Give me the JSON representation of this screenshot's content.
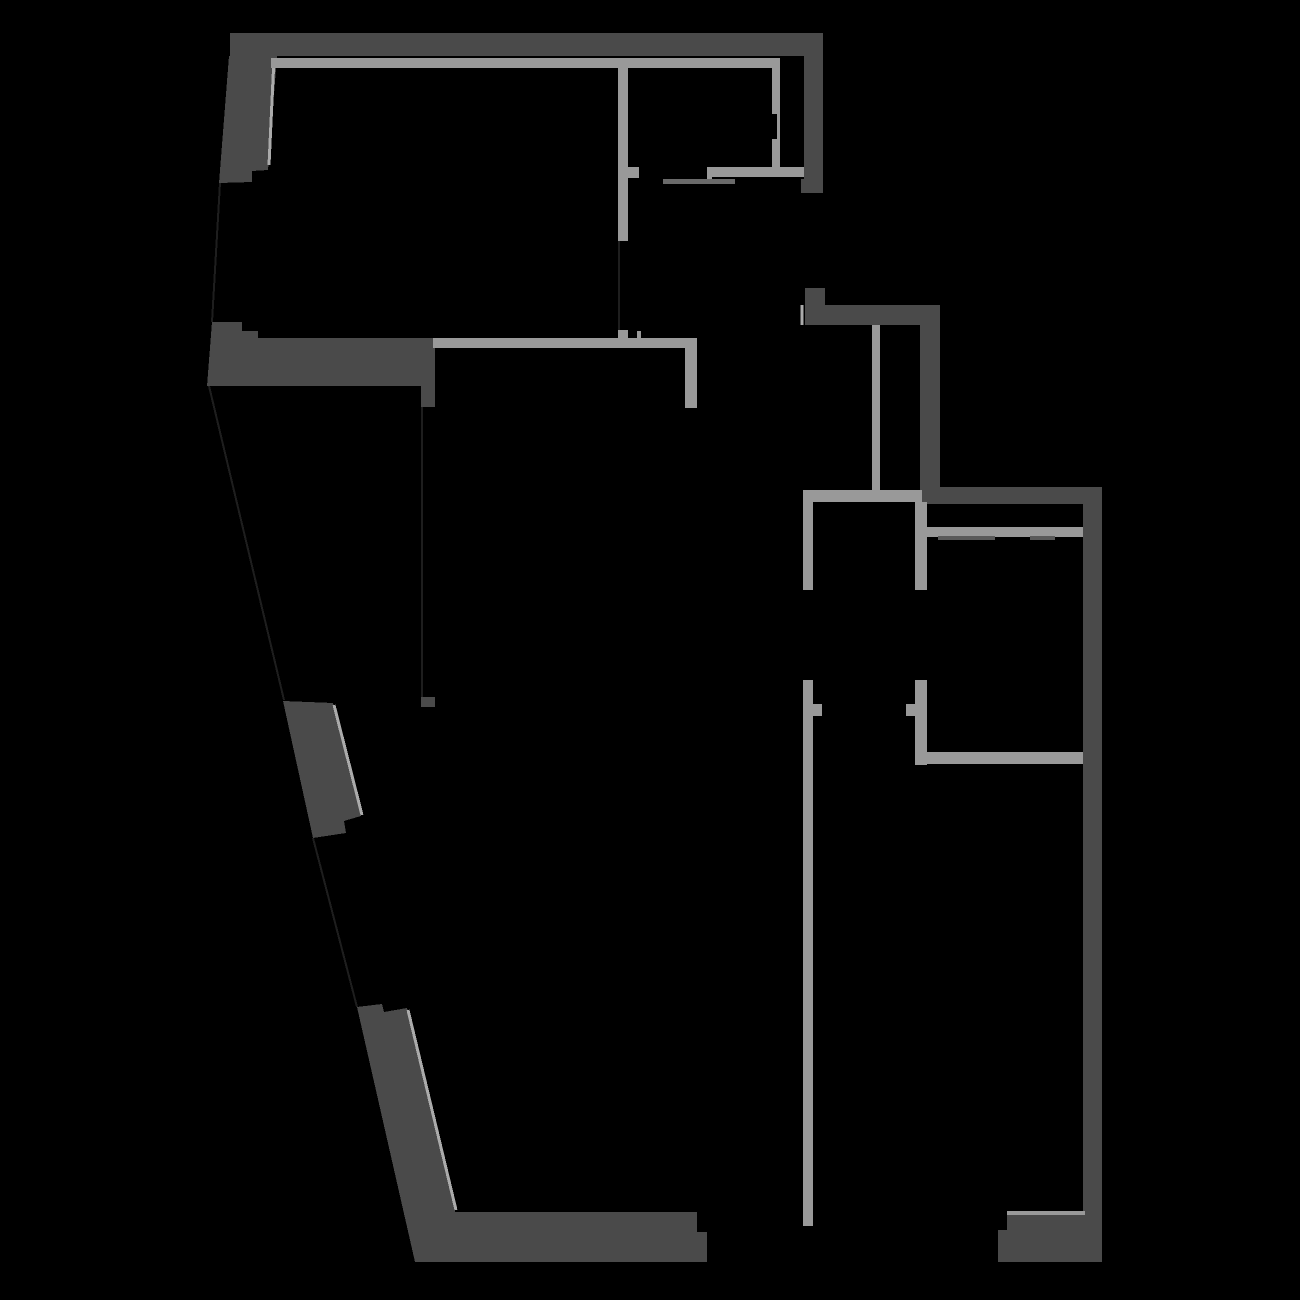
{
  "scene": {
    "type": "architectural-floor-plan",
    "background": "#000000",
    "canvas_width": 1300,
    "canvas_height": 1300
  },
  "colors": {
    "wall_dark": "#4a4a4a",
    "wall_light": "#999999",
    "edge_highlight": "#ababab",
    "door_leaf": "#6a6a6a",
    "wardrobe_line": "#5a5a5a",
    "faint_outline": "#1e1e1e",
    "background": "#000000"
  },
  "dark_walls": [
    {
      "name": "exterior-wall-top-band",
      "points": [
        [
          230,
          33
        ],
        [
          823,
          33
        ],
        [
          823,
          56
        ],
        [
          230,
          56
        ]
      ]
    },
    {
      "name": "exterior-wall-top-left",
      "points": [
        [
          229,
          56
        ],
        [
          277,
          56
        ],
        [
          268,
          170
        ],
        [
          252,
          171
        ],
        [
          252,
          182
        ],
        [
          219,
          183
        ]
      ]
    },
    {
      "name": "exterior-wall-top-right",
      "points": [
        [
          804,
          56
        ],
        [
          823,
          56
        ],
        [
          823,
          193
        ],
        [
          801,
          193
        ],
        [
          801,
          179
        ],
        [
          804,
          179
        ]
      ]
    },
    {
      "name": "exterior-wall-mid-left-band",
      "points": [
        [
          212,
          322
        ],
        [
          242,
          322
        ],
        [
          242,
          331
        ],
        [
          258,
          331
        ],
        [
          258,
          338
        ],
        [
          435,
          338
        ],
        [
          435,
          407
        ],
        [
          421,
          407
        ],
        [
          421,
          386
        ],
        [
          207,
          386
        ]
      ]
    },
    {
      "name": "window-pillar-left",
      "points": [
        [
          283,
          701
        ],
        [
          333,
          703
        ],
        [
          361,
          816
        ],
        [
          344,
          821
        ],
        [
          346,
          833
        ],
        [
          313,
          838
        ]
      ]
    },
    {
      "name": "exterior-wall-bottom-left-band",
      "points": [
        [
          357,
          1007
        ],
        [
          382,
          1004
        ],
        [
          384,
          1012
        ],
        [
          407,
          1008
        ],
        [
          455,
          1212
        ],
        [
          697,
          1212
        ],
        [
          697,
          1232
        ],
        [
          707,
          1232
        ],
        [
          707,
          1262
        ],
        [
          415,
          1262
        ]
      ]
    },
    {
      "name": "exterior-wall-right-hook",
      "points": [
        [
          805,
          288
        ],
        [
          825,
          288
        ],
        [
          825,
          305
        ],
        [
          940,
          305
        ],
        [
          940,
          487
        ],
        [
          920,
          487
        ],
        [
          920,
          325
        ],
        [
          805,
          325
        ]
      ]
    },
    {
      "name": "exterior-wall-right-main",
      "points": [
        [
          920,
          487
        ],
        [
          1102,
          487
        ],
        [
          1102,
          1262
        ],
        [
          998,
          1262
        ],
        [
          998,
          1230
        ],
        [
          1007,
          1230
        ],
        [
          1007,
          1215
        ],
        [
          1083,
          1215
        ],
        [
          1083,
          504
        ],
        [
          920,
          504
        ]
      ]
    },
    {
      "name": "wall-stub-lower",
      "points": [
        [
          421,
          697
        ],
        [
          435,
          697
        ],
        [
          435,
          707
        ],
        [
          421,
          707
        ]
      ]
    }
  ],
  "light_walls": [
    {
      "name": "interior-wall-under-top-band",
      "x": 271,
      "y": 58,
      "w": 507,
      "h": 10
    },
    {
      "name": "room1-left-wall",
      "x": 618,
      "y": 58,
      "w": 10,
      "h": 183
    },
    {
      "name": "room1-left-wall-tick",
      "x": 628,
      "y": 167,
      "w": 11,
      "h": 11
    },
    {
      "name": "room1-right-wall",
      "x": 772,
      "y": 58,
      "w": 8,
      "h": 109
    },
    {
      "name": "room1-bottom-wall",
      "x": 707,
      "y": 167,
      "w": 97,
      "h": 10
    },
    {
      "name": "room1-bottom-wall-tick",
      "x": 707,
      "y": 177,
      "w": 5,
      "h": 7
    },
    {
      "name": "interior-wall-mid-band",
      "x": 433,
      "y": 338,
      "w": 264,
      "h": 10
    },
    {
      "name": "interior-wall-mid-band-tick-a",
      "x": 618,
      "y": 330,
      "w": 10,
      "h": 8
    },
    {
      "name": "interior-wall-mid-band-tick-b",
      "x": 637,
      "y": 331,
      "w": 4,
      "h": 7
    },
    {
      "name": "interior-wall-mid-vertical",
      "x": 685,
      "y": 348,
      "w": 12,
      "h": 60
    },
    {
      "name": "shaft-divider-wall",
      "x": 872,
      "y": 325,
      "w": 8,
      "h": 165
    },
    {
      "name": "hall-top-wall",
      "x": 803,
      "y": 490,
      "w": 119,
      "h": 12
    },
    {
      "name": "corridor-left-wall-upper",
      "x": 803,
      "y": 502,
      "w": 10,
      "h": 88
    },
    {
      "name": "corridor-left-wall-lower",
      "x": 803,
      "y": 680,
      "w": 10,
      "h": 546
    },
    {
      "name": "corridor-left-door-tick",
      "x": 813,
      "y": 704,
      "w": 9,
      "h": 12
    },
    {
      "name": "corridor-right-wall-upper",
      "x": 915,
      "y": 502,
      "w": 12,
      "h": 88
    },
    {
      "name": "corridor-right-wall-lower",
      "x": 915,
      "y": 680,
      "w": 12,
      "h": 85
    },
    {
      "name": "corridor-right-door-tick",
      "x": 906,
      "y": 704,
      "w": 9,
      "h": 12
    },
    {
      "name": "bedroom-bottom-wall",
      "x": 921,
      "y": 752,
      "w": 162,
      "h": 12
    },
    {
      "name": "bedroom-top-wall",
      "x": 920,
      "y": 527,
      "w": 163,
      "h": 10
    },
    {
      "name": "bottom-band-top-edge",
      "x": 1007,
      "y": 1211,
      "w": 78,
      "h": 4
    }
  ],
  "edge_highlights": [
    {
      "name": "highlight-top-left-wall",
      "x1": 274,
      "y1": 58,
      "x2": 269,
      "y2": 165,
      "width": 3
    },
    {
      "name": "highlight-window-pillar",
      "x1": 334,
      "y1": 705,
      "x2": 362,
      "y2": 815,
      "width": 3
    },
    {
      "name": "highlight-bottom-slant-wall",
      "x1": 408,
      "y1": 1010,
      "x2": 456,
      "y2": 1210,
      "width": 3
    },
    {
      "name": "highlight-hook-band-left",
      "x1": 802,
      "y1": 305,
      "x2": 802,
      "y2": 325,
      "width": 3
    }
  ],
  "faint_outlines": [
    {
      "name": "window-opening-outline-1",
      "x1": 220,
      "y1": 183,
      "x2": 212,
      "y2": 322
    },
    {
      "name": "window-opening-outline-2",
      "x1": 209,
      "y1": 386,
      "x2": 284,
      "y2": 700
    },
    {
      "name": "window-opening-outline-3",
      "x1": 313,
      "y1": 838,
      "x2": 357,
      "y2": 1007
    },
    {
      "name": "removed-wall-outline",
      "x1": 422,
      "y1": 407,
      "x2": 422,
      "y2": 697
    },
    {
      "name": "door-opening-outline",
      "x1": 619,
      "y1": 241,
      "x2": 619,
      "y2": 330
    }
  ],
  "accents": [
    {
      "name": "door-leaf-room1",
      "x": 663,
      "y": 179,
      "w": 72,
      "h": 5,
      "color": "#6a6a6a"
    },
    {
      "name": "wardrobe-line-1",
      "x": 938,
      "y": 536,
      "w": 57,
      "h": 4,
      "color": "#5a5a5a"
    },
    {
      "name": "wardrobe-line-2",
      "x": 1030,
      "y": 536,
      "w": 25,
      "h": 4,
      "color": "#5a5a5a"
    },
    {
      "name": "room1-right-wall-notch",
      "x": 772,
      "y": 114,
      "w": 5,
      "h": 25,
      "color": "#000000"
    }
  ]
}
